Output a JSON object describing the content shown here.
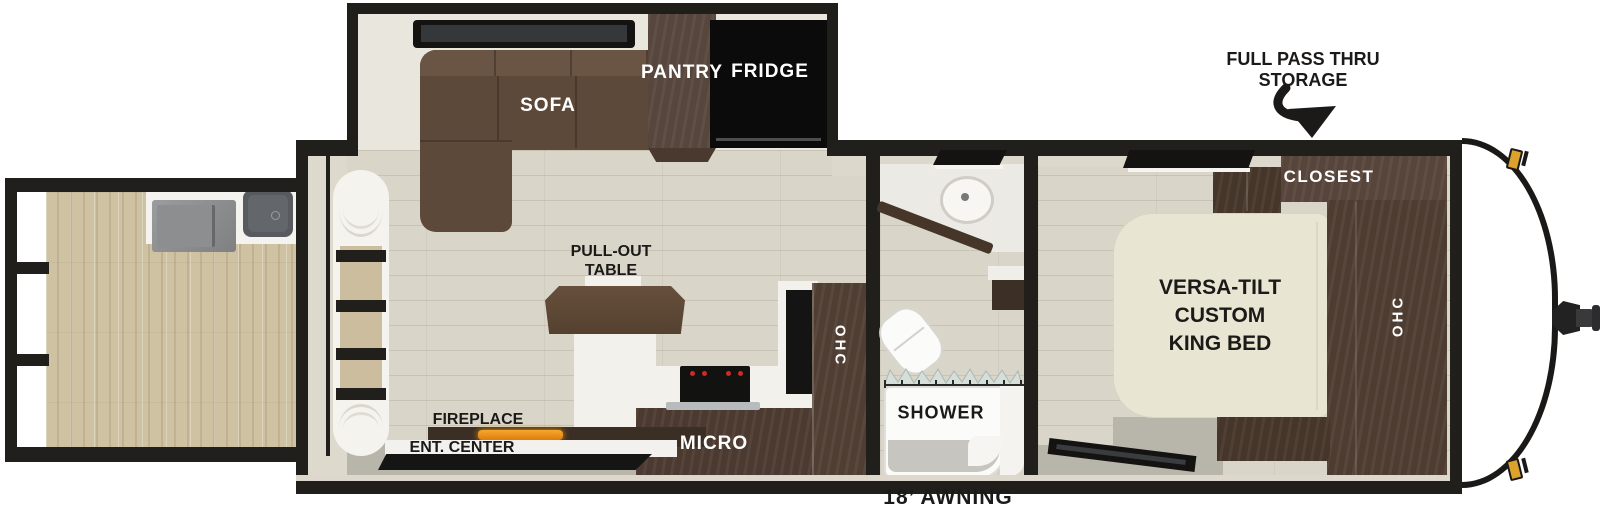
{
  "labels": {
    "sofa": "SOFA",
    "pantry": "PANTRY",
    "fridge": "FRIDGE",
    "pull_out_table": [
      "PULL-OUT",
      "TABLE"
    ],
    "fireplace": "FIREPLACE",
    "ent_center": "ENT. CENTER",
    "micro": "MICRO",
    "ohc_kitchen": "OHC",
    "shower": "SHOWER",
    "closet": "CLOSEST",
    "ohc_bedroom": "OHC",
    "king_bed": [
      "VERSA-TILT",
      "CUSTOM",
      "KING BED"
    ],
    "pass_thru_storage": [
      "FULL PASS THRU",
      "STORAGE"
    ],
    "awning": "18’ AWNING"
  },
  "colors": {
    "wall_black": "#211f1c",
    "cabinet_dark_brown": "#4e3c32",
    "sofa_brown": "#5d4939",
    "bed_cream": "#e9e5d3",
    "floor_main_greige": "#d9d6c9",
    "floor_deck_tan": "#cfc2a2",
    "walkway_grey": "#b8b5aa",
    "fridge_black": "#0b0b0b",
    "counter_white": "#f2f1ec",
    "marker_light_amber": "#dba32d",
    "flame_orange": "#e8920f"
  }
}
